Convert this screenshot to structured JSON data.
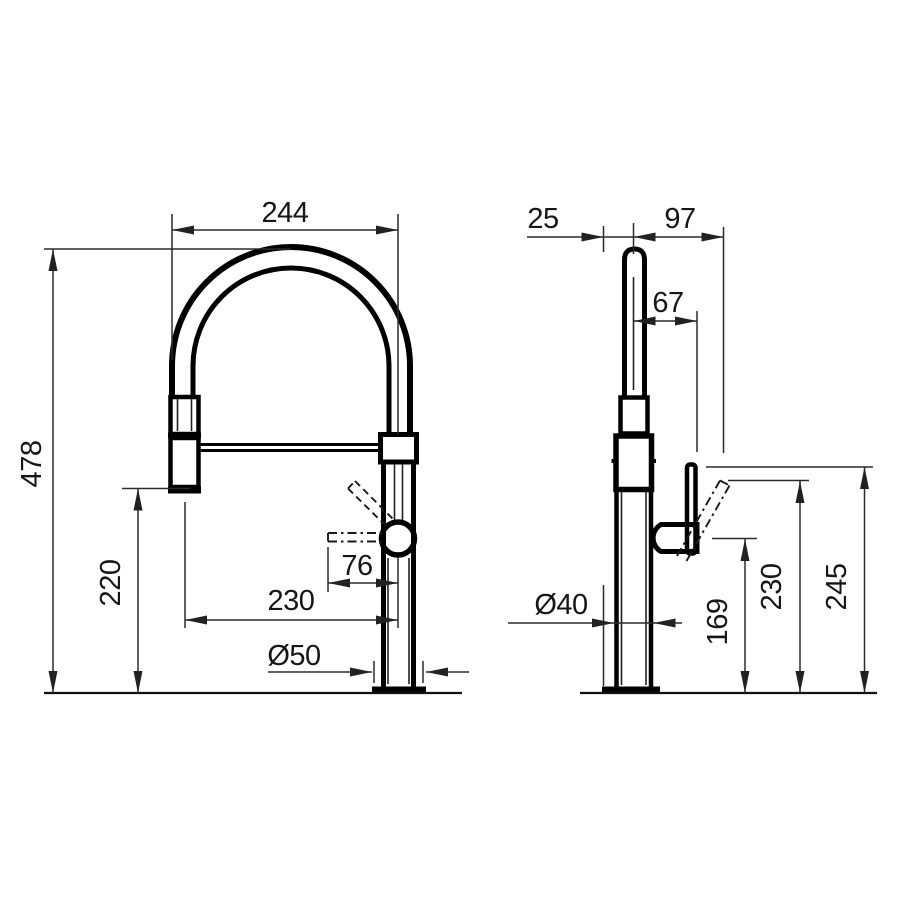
{
  "drawing": {
    "type": "faucet technical dimension drawing",
    "views": [
      "front",
      "side"
    ],
    "units": "mm",
    "front": {
      "dims": {
        "spout_arc_width": "244",
        "overall_height": "478",
        "spray_head_clearance": "220",
        "spout_reach": "230",
        "handle_length": "76",
        "base_diameter": "Ø50"
      }
    },
    "side": {
      "dims": {
        "back_offset": "25",
        "front_reach": "97",
        "spout_to_lever": "67",
        "column_diameter": "Ø40",
        "handle_axis_height": "169",
        "lever_tilted_height": "230",
        "lever_top_height": "245"
      }
    }
  }
}
